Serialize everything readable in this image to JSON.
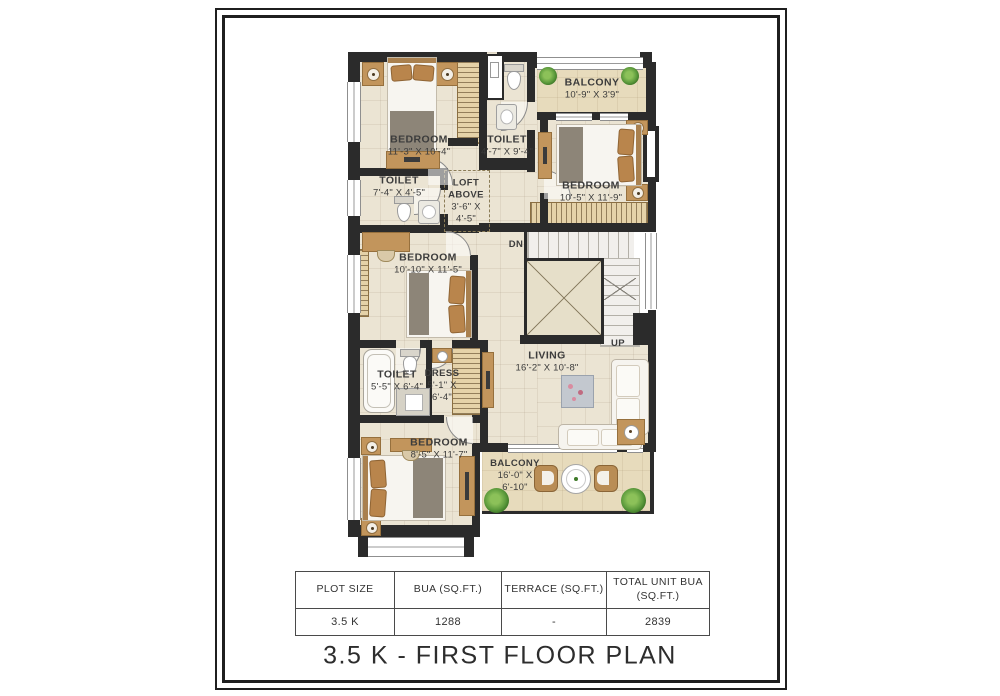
{
  "page": {
    "title": "3.5 K - FIRST FLOOR PLAN"
  },
  "table": {
    "headers": [
      "PLOT SIZE",
      "BUA (SQ.FT.)",
      "TERRACE (SQ.FT.)",
      "TOTAL UNIT BUA (SQ.FT.)"
    ],
    "row": [
      "3.5 K",
      "1288",
      "-",
      "2839"
    ]
  },
  "plan": {
    "rooms": [
      {
        "name": "BEDROOM",
        "dims": "11'-3\" X 10'-4\""
      },
      {
        "name": "TOILET",
        "dims": "7'-4\" X 4'-5\""
      },
      {
        "name": "TOILET",
        "dims": "4'-7\" X 9'-4\""
      },
      {
        "name": "BALCONY",
        "dims": "10'-9\" X 3'9\""
      },
      {
        "name": "BEDROOM",
        "dims": "10'-5\" X 11'-9\""
      },
      {
        "name": "LOFT ABOVE",
        "dims": "3'-6\" X 4'-5\""
      },
      {
        "name": "BEDROOM",
        "dims": "10'-10\" X 11'-5\""
      },
      {
        "name": "LIVING",
        "dims": "16'-2\" X 10'-8\""
      },
      {
        "name": "TOILET",
        "dims": "5'-5\" X 6'-4\""
      },
      {
        "name": "DRESS",
        "dims": "5'-1\" X 6'-4\""
      },
      {
        "name": "BEDROOM",
        "dims": "8'-5\" X 11'-7\""
      },
      {
        "name": "BALCONY",
        "dims": "16'-0\" X 6'-10\""
      }
    ],
    "stairs": {
      "dn": "DN",
      "up": "UP"
    }
  },
  "colors": {
    "wall": "#2b2b2b",
    "floor": "#ebe4d3",
    "balcony_floor": "#e7dbbc",
    "wood": "#c2955c",
    "blanket": "#8d8578",
    "plant": "#5c9a3c",
    "text": "#3c3c3c"
  }
}
